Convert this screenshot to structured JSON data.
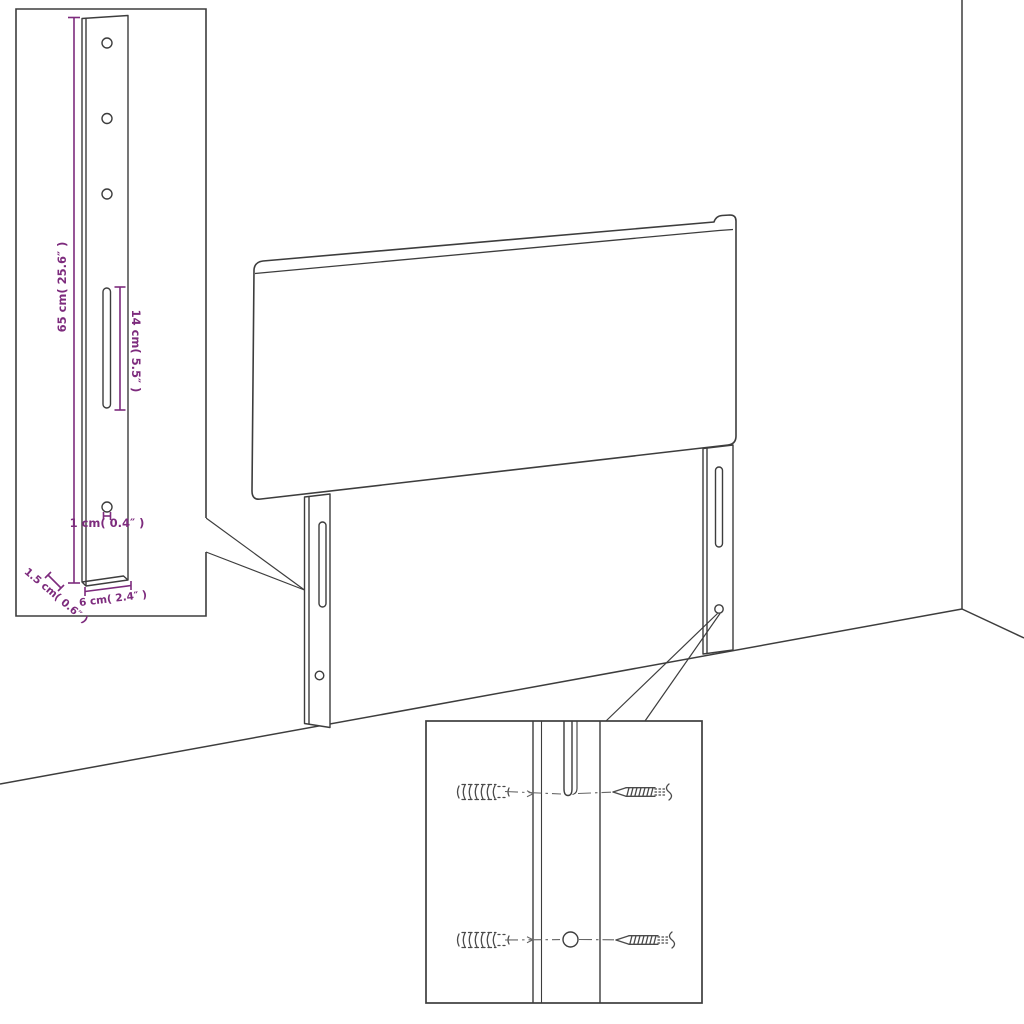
{
  "page": {
    "background_color": "#ffffff",
    "description": "Line-art assembly diagram of an upholstered headboard with two slotted mounting legs, a magnified leg inset with dimensions, and a magnified wall-fixing inset showing wall plugs and screws."
  },
  "colors": {
    "line": "#3d3d3d",
    "dimension": "#7d2b7d",
    "background": "#ffffff"
  },
  "leg_detail_inset": {
    "labels": {
      "leg_height": "65 cm( 25.6″ )",
      "slot_length": "14 cm( 5.5″ )",
      "hole_size": "1 cm( 0.4″ )",
      "leg_depth": "1.5 cm( 0.6″ )",
      "leg_width": "6 cm( 2.4″ )"
    },
    "features": [
      "three-screw-holes",
      "adjustment-slot",
      "bottom-hole"
    ]
  },
  "fixing_detail_inset": {
    "hardware": [
      "wall-plug",
      "screw",
      "wall-plug",
      "screw"
    ],
    "features": [
      "leg-slot-top",
      "leg-hole-bottom"
    ]
  },
  "main_view": {
    "parts": [
      "headboard-panel",
      "left-leg",
      "right-leg",
      "room-corner"
    ]
  }
}
